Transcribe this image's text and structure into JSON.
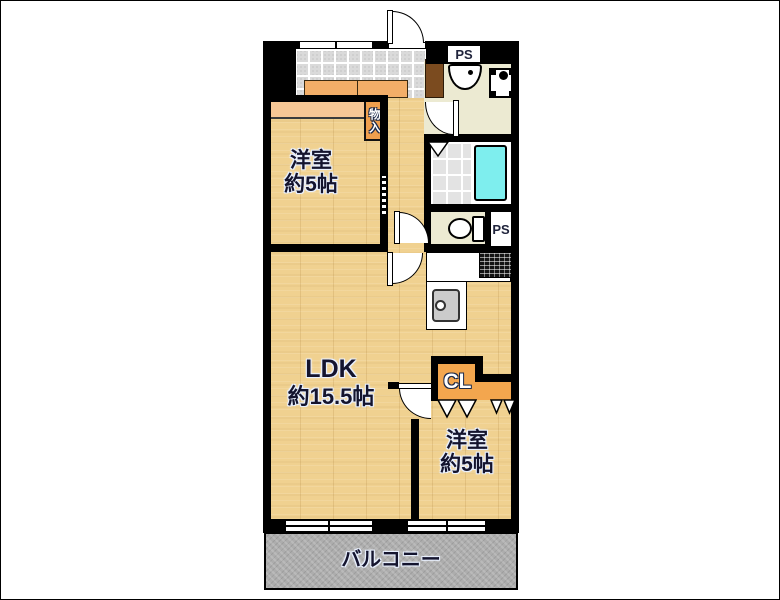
{
  "floorplan": {
    "type": "apartment-floor-plan",
    "labels": {
      "bedroom1_line1": "洋室",
      "bedroom1_line2": "約5帖",
      "ldk_line1": "LDK",
      "ldk_line2": "約15.5帖",
      "bedroom2_line1": "洋室",
      "bedroom2_line2": "約5帖",
      "balcony": "バルコニー",
      "closet": "CL",
      "storage": "物入",
      "pipe_space_top": "PS",
      "pipe_space_bottom": "PS"
    },
    "fixtures": [
      "bathtub",
      "toilet",
      "washbasin",
      "washing-machine-pan",
      "kitchen-sink",
      "gas-stove",
      "entrance-door",
      "swing-doors",
      "folding-doors",
      "sliding-windows",
      "shoe-cabinet",
      "storage-closet"
    ],
    "colors": {
      "wall": "#000000",
      "wood_floor": "#f0d190",
      "entrance_tile": "#dadada",
      "washroom_floor": "#ecead2",
      "bathroom_floor": "#e3e3e3",
      "bathtub": "#7eeeee",
      "closet_orange": "#f3a64e",
      "closet_peach": "#f7c795",
      "shoe_cabinet_orange": "#f2ae68",
      "cabinet_brown": "#7b4b1f",
      "balcony_gray": "#adadad",
      "label_text": "#14142e"
    }
  }
}
